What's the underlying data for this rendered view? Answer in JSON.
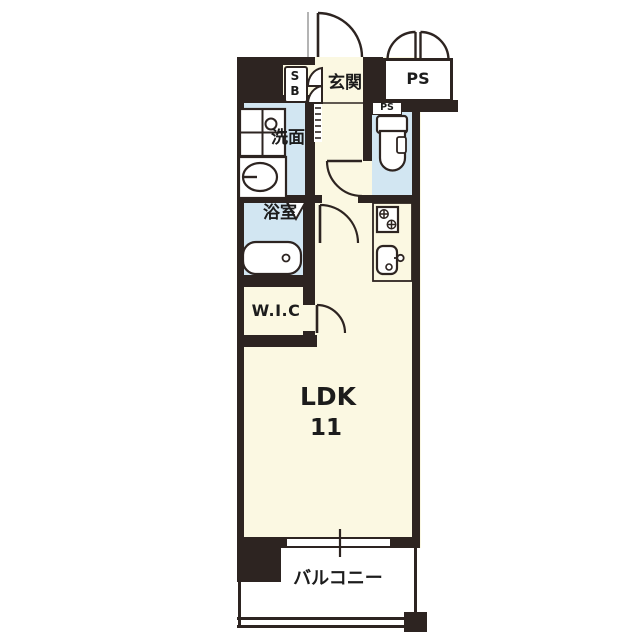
{
  "plan": {
    "type": "apartment-floor-plan",
    "rooms": {
      "entrance": {
        "label": "玄関"
      },
      "shoe_box": {
        "label": "SB"
      },
      "pipe_space": {
        "label": "PS"
      },
      "pipe_space_duct": {
        "label": "PS"
      },
      "washroom": {
        "label": "洗面"
      },
      "bathroom": {
        "label": "浴室"
      },
      "walk_in_closet": {
        "label": "W.I.C"
      },
      "ldk": {
        "label": "LDK",
        "size": "11"
      },
      "balcony": {
        "label": "バルコニー"
      }
    },
    "colors": {
      "wall": "#2d2421",
      "room_floor": "#fbf8e2",
      "wet_area": "#d2e6f2",
      "fixture": "#ffffff",
      "background": "#ffffff",
      "text": "#1c1c1c"
    }
  }
}
